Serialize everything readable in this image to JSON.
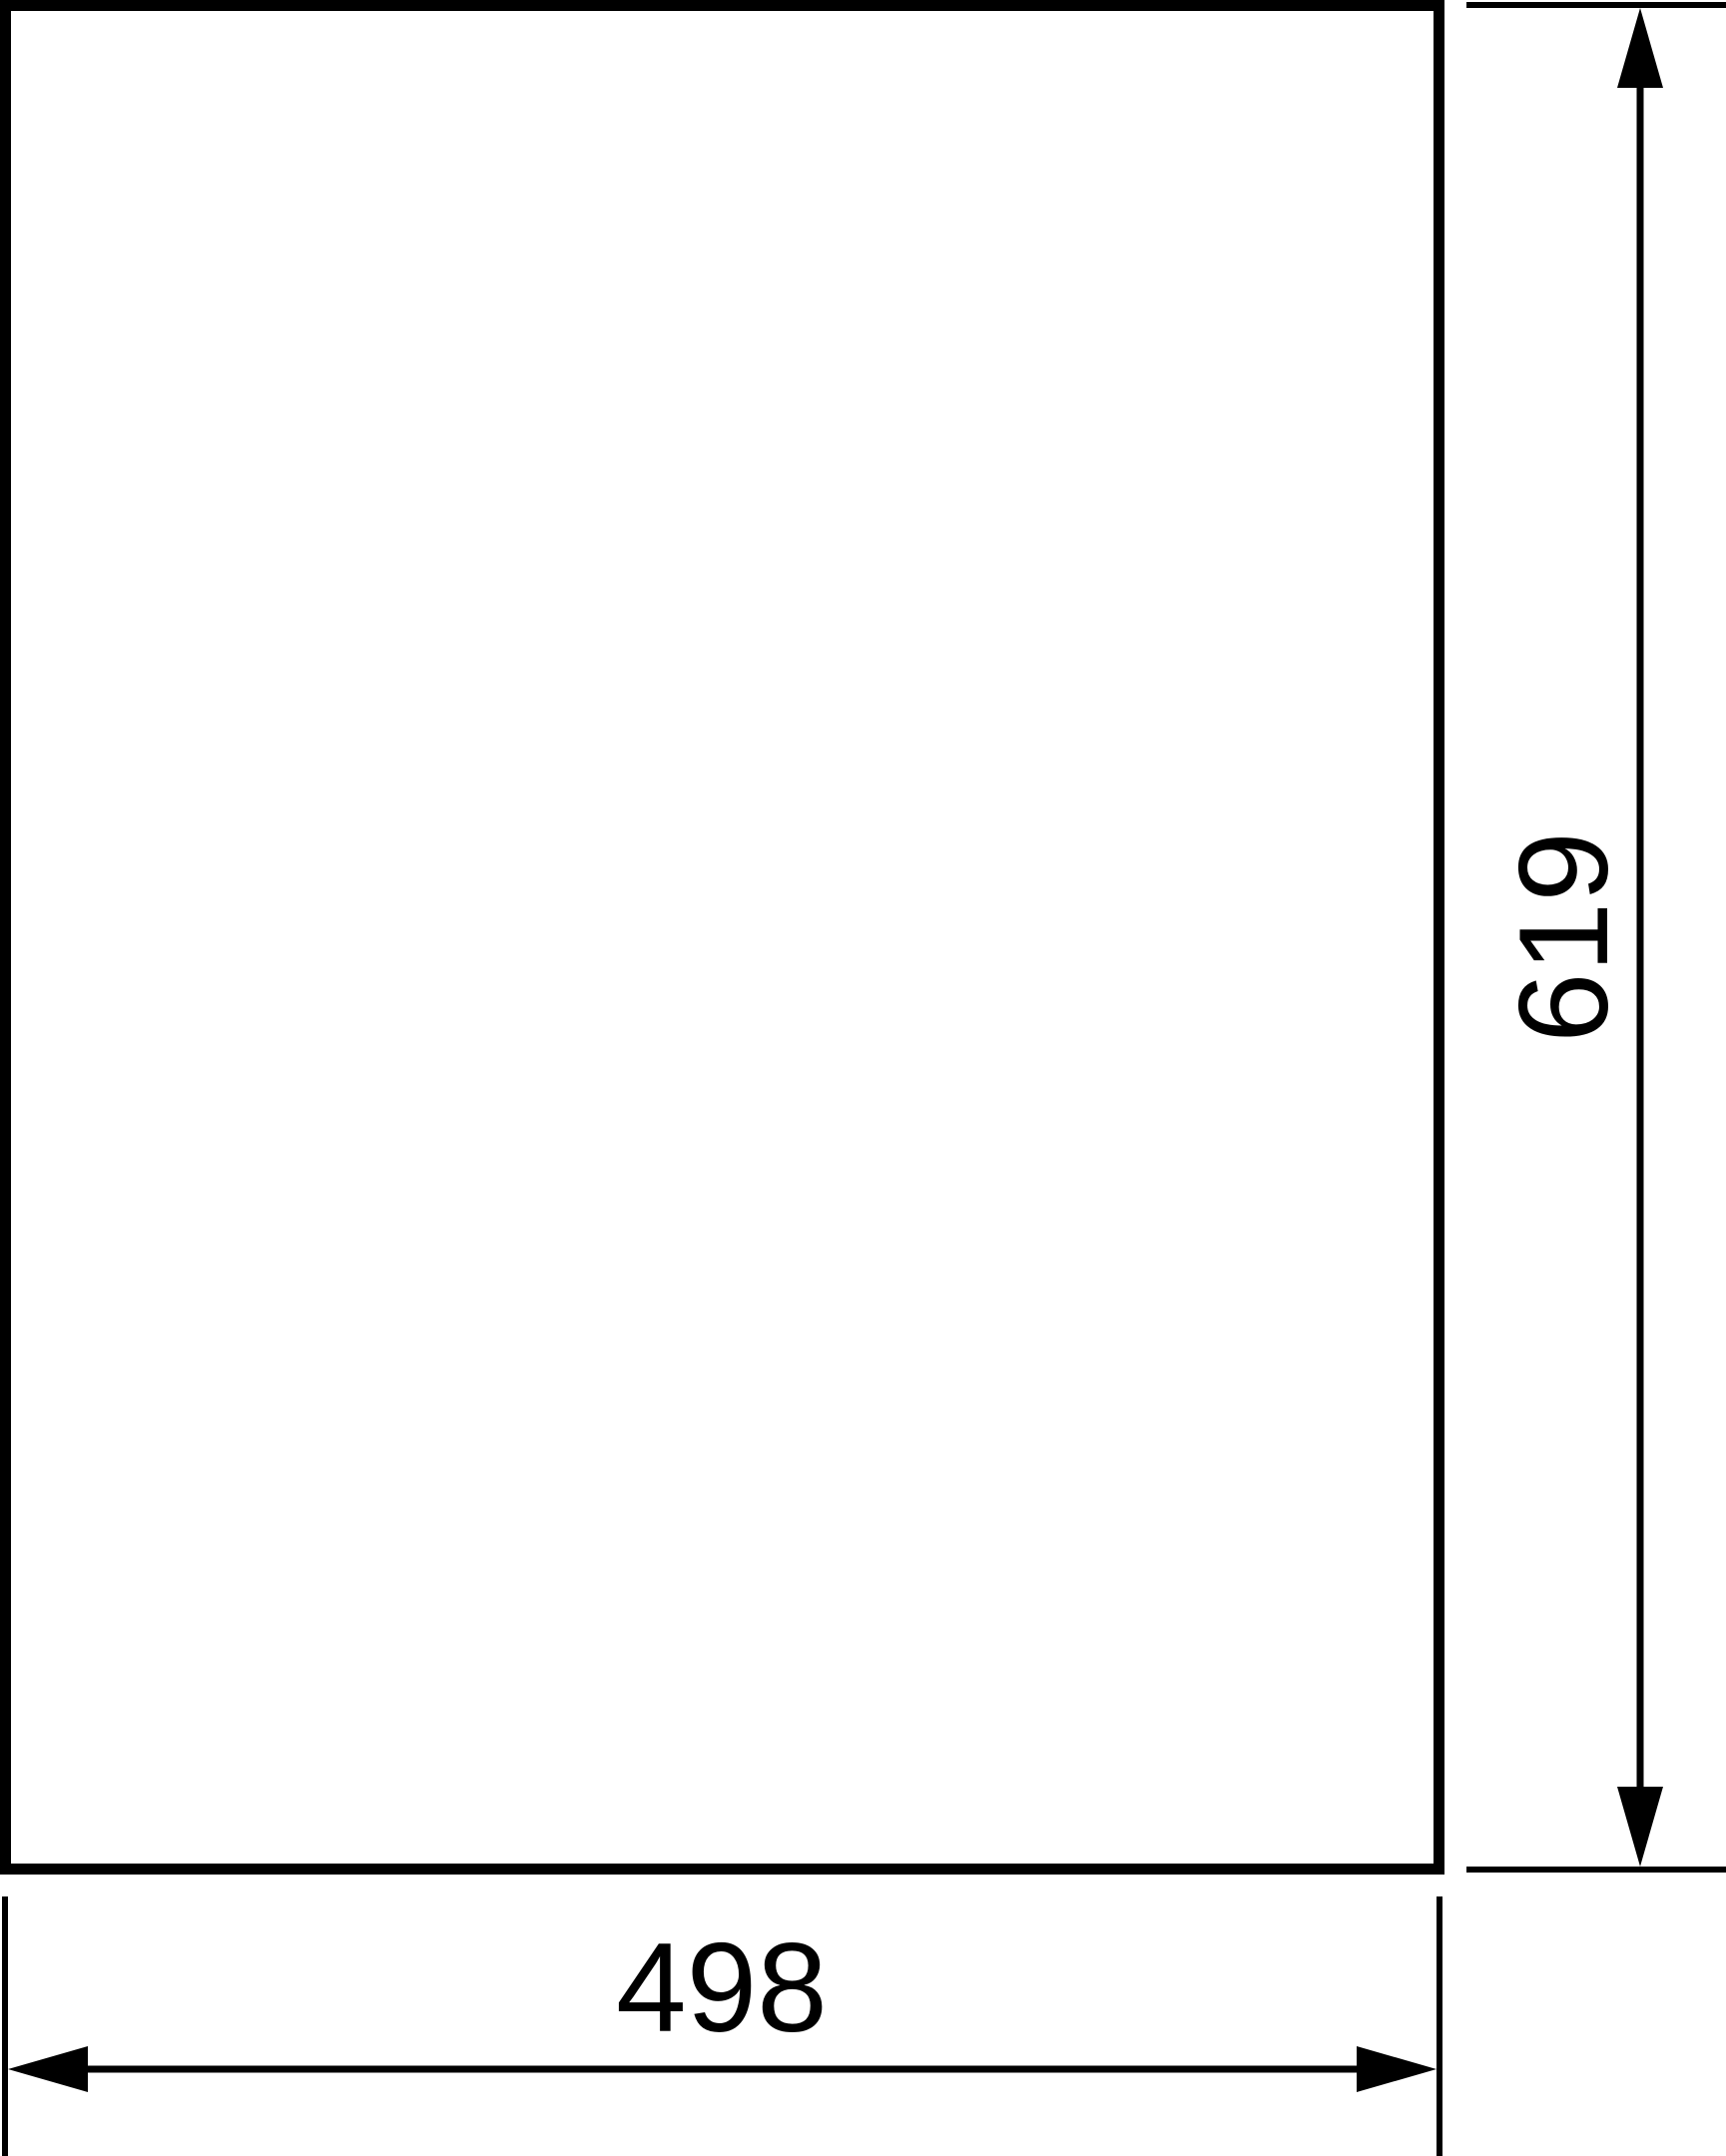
{
  "drawing": {
    "kind": "technical-dimension-drawing",
    "part_outline": {
      "shape": "rectangle"
    },
    "width_dimension": {
      "value": "498"
    },
    "height_dimension": {
      "value": "619"
    },
    "colors": {
      "line": "#000000",
      "background": "#ffffff"
    }
  }
}
